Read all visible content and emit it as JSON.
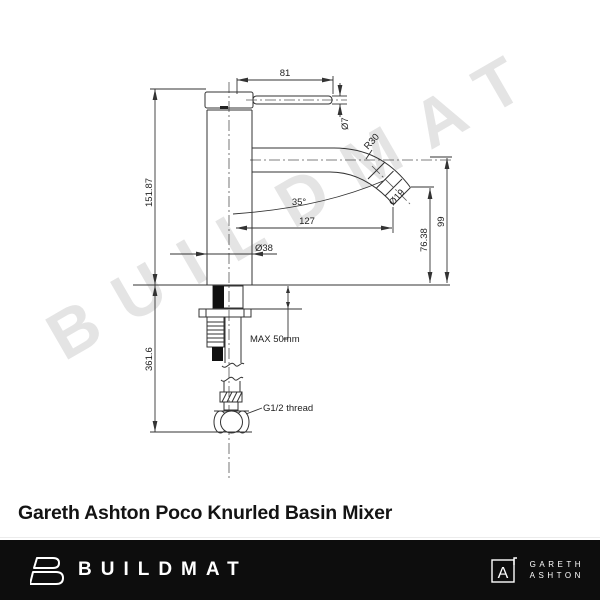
{
  "watermark": "BUILDMAT",
  "title": "Gareth Ashton Poco Knurled Basin Mixer",
  "drawing": {
    "dims": {
      "lever_length": "81",
      "lever_diameter": "Ø7",
      "spout_radius": "R30",
      "height_above_bench": "151.87",
      "spout_angle": "35°",
      "spout_reach": "127",
      "body_diameter": "Ø38",
      "tip_diameter": "Ø19",
      "outlet_height": "76.38",
      "spout_centre_height": "99",
      "under_bench_length": "361.6",
      "max_bench_thickness": "MAX 50mm",
      "inlet_thread": "G1/2 thread"
    }
  },
  "footer": {
    "buildmat_wordmark": "BUILDMAT",
    "brand_monogram": "A",
    "brand_line1": "GARETH",
    "brand_line2": "ASHTON"
  },
  "colors": {
    "footer_bg": "#0d0d0d",
    "watermark": "#e4e4e4",
    "drawing_line": "#333333"
  }
}
